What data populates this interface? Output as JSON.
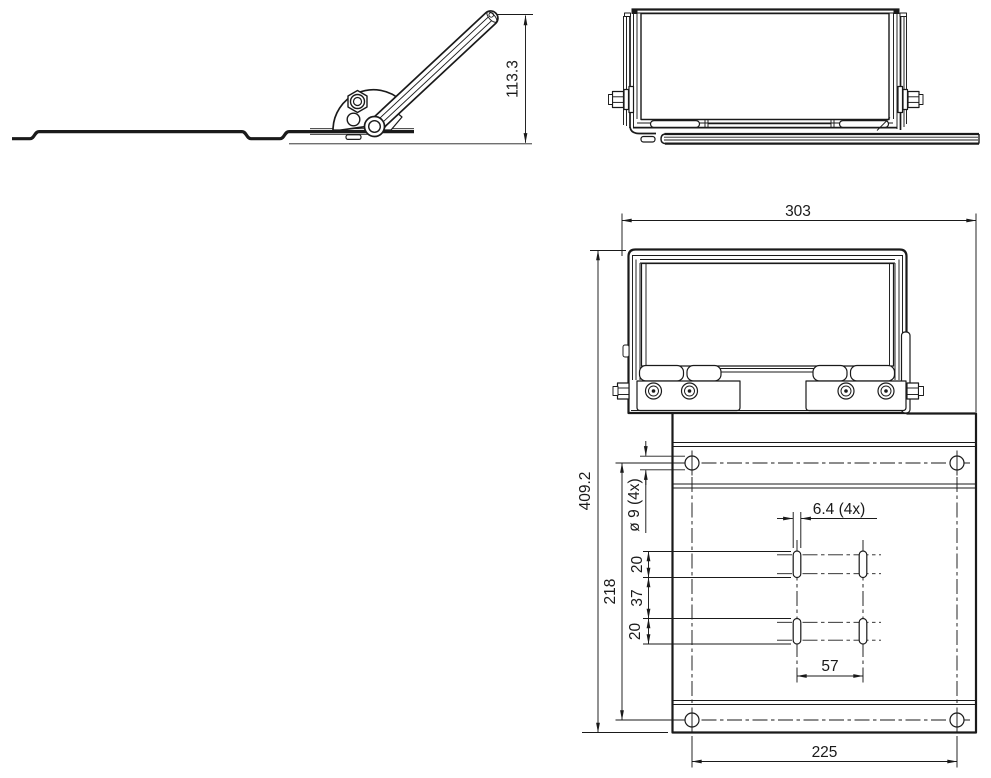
{
  "drawing": {
    "background_color": "#ffffff",
    "line_color": "#1a1a1a",
    "side_view": {
      "dimensions": {
        "arm_height": "113.3"
      }
    },
    "plan_view": {
      "dimensions": {
        "overall_width": "303",
        "overall_depth": "409.2",
        "hole_note": "ø 9 (4x)",
        "hole_row_spacing": "218",
        "slot_upper_length": "20",
        "slot_gap": "37",
        "slot_lower_length": "20",
        "slot_width_note": "6.4 (4x)",
        "slot_pitch": "57",
        "bottom_hole_pitch": "225"
      }
    }
  }
}
